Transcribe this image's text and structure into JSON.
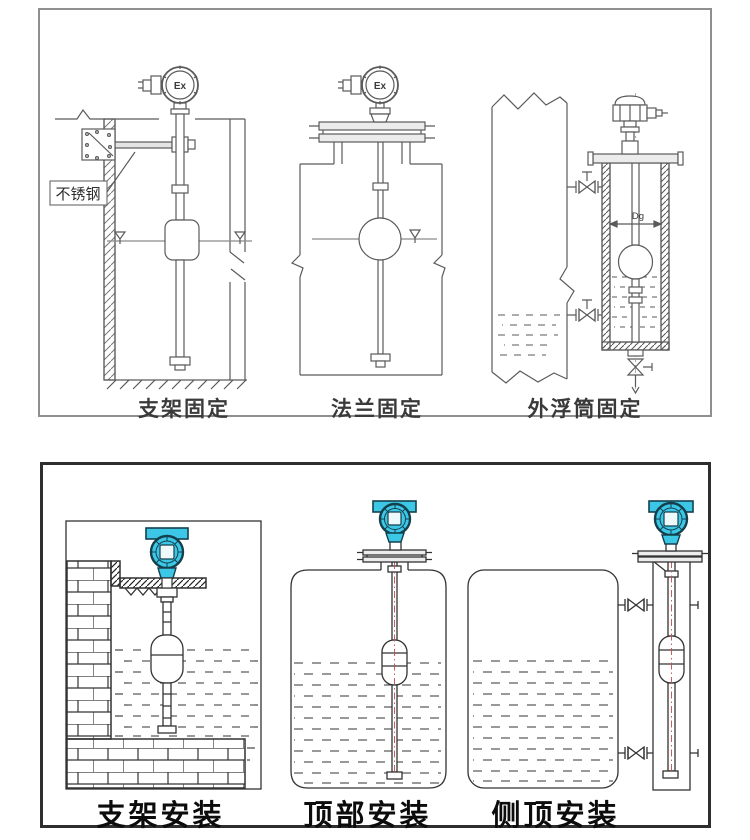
{
  "colors": {
    "line_top": "#5a5a5a",
    "line_bottom": "#333333",
    "transmitter_cyan": "#3cc7e6",
    "transmitter_outline": "#14404e",
    "rod_centerline_red": "#c0504d",
    "panel_top_border": "#8f8f8f",
    "panel_bottom_border": "#2e2e2e"
  },
  "top_panel": {
    "ex_label": "Ex",
    "stainless_steel_label": "不锈钢",
    "diameter_label": "Dg",
    "captions": [
      {
        "label": "支架固定"
      },
      {
        "label": "法兰固定"
      },
      {
        "label": "外浮筒固定"
      }
    ]
  },
  "bottom_panel": {
    "captions": [
      {
        "label": "支架安装"
      },
      {
        "label": "顶部安装"
      },
      {
        "label": "侧顶安装"
      }
    ]
  }
}
